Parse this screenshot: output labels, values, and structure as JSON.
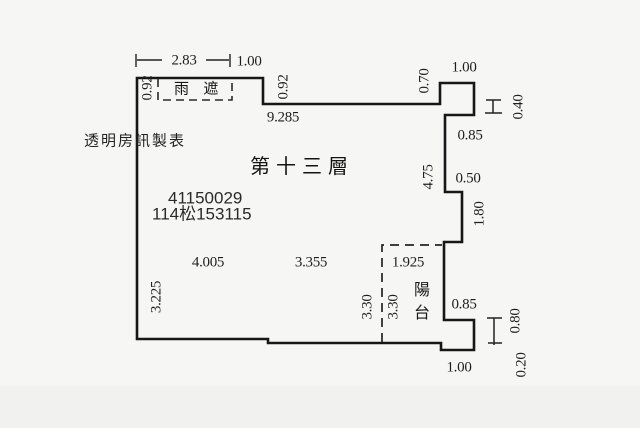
{
  "plan": {
    "floor_title": "第十三層",
    "maker": "透明房訊製表",
    "case_number": "41150029",
    "registration_number": "114松153115",
    "canopy_label": "雨　遮",
    "balcony_label": "陽台"
  },
  "dimensions": {
    "canopy_width": "2.83",
    "canopy_side_width": "1.00",
    "canopy_depth_left": "0.92",
    "canopy_depth_right": "0.92",
    "top_wall_length": "9.285",
    "notch_height": "0.70",
    "notch_width": "1.00",
    "window_upper": "0.40",
    "step_upper_width": "0.85",
    "right_wall_upper": "4.75",
    "step_mid_width": "0.50",
    "right_wall_mid": "1.80",
    "interior_width_left": "4.005",
    "interior_width_right": "3.355",
    "balcony_width": "1.925",
    "interior_height": "3.30",
    "balcony_height": "3.30",
    "left_wall_lower": "3.225",
    "step_lower_width": "0.85",
    "wall_lower_right": "0.80",
    "bottom_step_height": "0.20",
    "bottom_exit_width": "1.00"
  },
  "colors": {
    "background": "#f6f6f4",
    "line": "#171717"
  }
}
